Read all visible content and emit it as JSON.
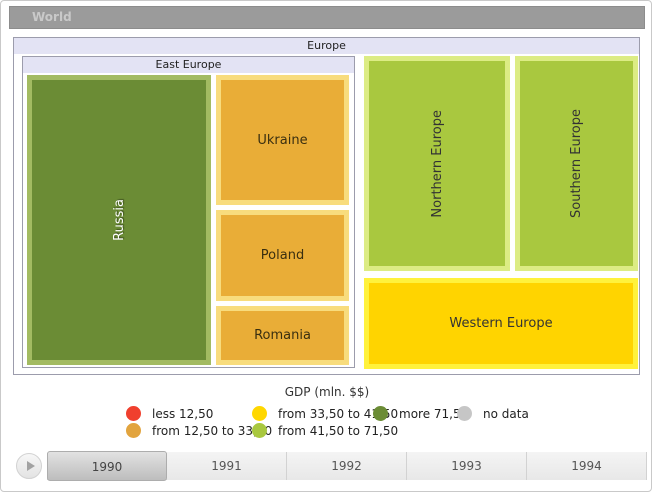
{
  "breadcrumb": {
    "world_label": "World"
  },
  "treemap": {
    "europe_label": "Europe",
    "east_europe_label": "East Europe",
    "nodes": {
      "russia": "Russia",
      "ukraine": "Ukraine",
      "poland": "Poland",
      "romania": "Romania",
      "northern_europe": "Northern Europe",
      "southern_europe": "Southern Europe",
      "western_europe": "Western Europe"
    }
  },
  "legend": {
    "title": "GDP (mln. $$)",
    "items": [
      {
        "label": "less 12,50",
        "color": "#f0402e"
      },
      {
        "label": "from 12,50 to 33,50",
        "color": "#e2a43e"
      },
      {
        "label": "from 33,50 to 41,50",
        "color": "#ffd700"
      },
      {
        "label": "from 41,50 to 71,50",
        "color": "#a9c83f"
      },
      {
        "label": "more 71,50",
        "color": "#6b8c35"
      },
      {
        "label": "no data",
        "color": "#c6c6c6"
      }
    ]
  },
  "timeline": {
    "years": [
      "1990",
      "1991",
      "1992",
      "1993",
      "1994"
    ],
    "selected_year": "1990"
  },
  "chart_data": {
    "type": "treemap",
    "title": "GDP (mln. $$)",
    "root": "World",
    "legend_position": "bottom",
    "selected_year": "1990",
    "years": [
      "1990",
      "1991",
      "1992",
      "1993",
      "1994"
    ],
    "color_scale": [
      {
        "label": "less 12,50",
        "color": "#f0402e"
      },
      {
        "label": "from 12,50 to 33,50",
        "color": "#e2a43e"
      },
      {
        "label": "from 33,50 to 41,50",
        "color": "#ffd700"
      },
      {
        "label": "from 41,50 to 71,50",
        "color": "#a9c83f"
      },
      {
        "label": "more 71,50",
        "color": "#6b8c35"
      },
      {
        "label": "no data",
        "color": "#c6c6c6"
      }
    ],
    "tree": {
      "label": "Europe",
      "children": [
        {
          "label": "East Europe",
          "children": [
            {
              "label": "Russia",
              "color": "#6b8c35",
              "category": "more 71,50"
            },
            {
              "label": "Ukraine",
              "color": "#e9ad37",
              "category": "from 12,50 to 33,50"
            },
            {
              "label": "Poland",
              "color": "#e9ad37",
              "category": "from 12,50 to 33,50"
            },
            {
              "label": "Romania",
              "color": "#e9ad37",
              "category": "from 12,50 to 33,50"
            }
          ]
        },
        {
          "label": "Northern Europe",
          "color": "#a9c83f",
          "category": "from 41,50 to 71,50"
        },
        {
          "label": "Southern Europe",
          "color": "#a9c83f",
          "category": "from 41,50 to 71,50"
        },
        {
          "label": "Western Europe",
          "color": "#ffd400",
          "category": "from 33,50 to 41,50"
        }
      ]
    }
  }
}
